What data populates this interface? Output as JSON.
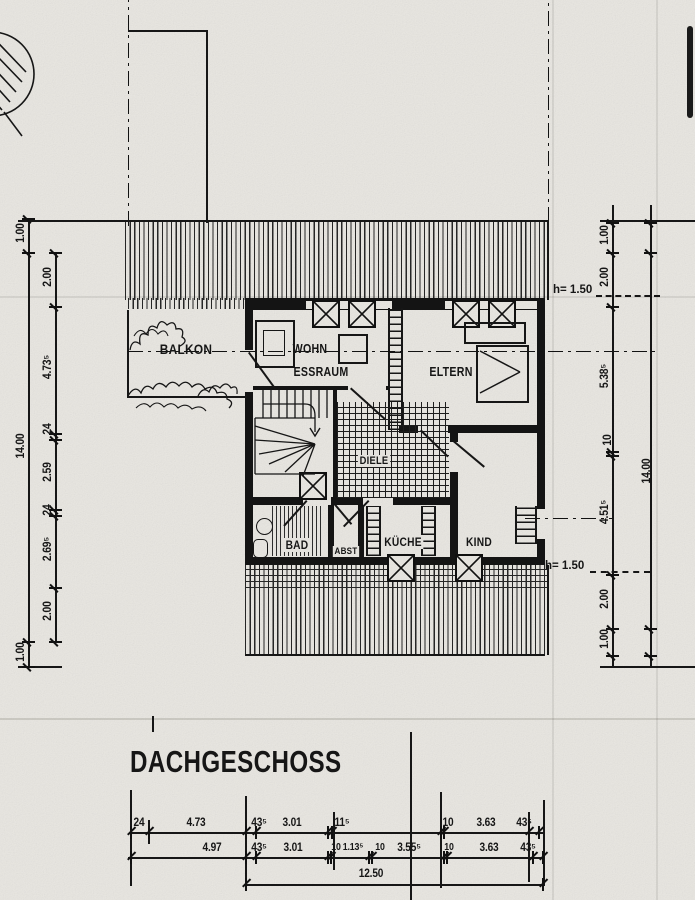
{
  "title": "DACHGESCHOSS",
  "rooms": {
    "balkon": "BALKON",
    "wohn": "WOHN",
    "essraum": "ESSRAUM",
    "eltern": "ELTERN",
    "diele": "DIELE",
    "bad": "BAD",
    "abst": "ABST",
    "kueche": "KÜCHE",
    "kind": "KIND"
  },
  "annotations": {
    "roof_height_top": "h= 1.50",
    "roof_height_bottom": "h= 1.50"
  },
  "dimensions": {
    "left_outer": [
      "1.00",
      "14.00",
      "1.00"
    ],
    "left_inner": [
      "2.00",
      "4.73⁵",
      "24",
      "2.59",
      "24",
      "2.69⁵",
      "2.00"
    ],
    "right_inner": [
      "1.00",
      "2.00",
      "5.38⁵",
      "10",
      "4.51⁵",
      "2.00",
      "1.00"
    ],
    "right_outer": [
      "14.00"
    ],
    "bottom_upper": [
      "24",
      "4.73",
      "43⁵",
      "3.01",
      "11⁵",
      "10",
      "3.63",
      "43⁵"
    ],
    "bottom_lower": [
      "4.97",
      "43⁵",
      "3.01",
      "10",
      "1.13⁵",
      "10",
      "3.55⁵",
      "10",
      "3.63",
      "43⁵"
    ],
    "bottom_total": "12.50"
  }
}
